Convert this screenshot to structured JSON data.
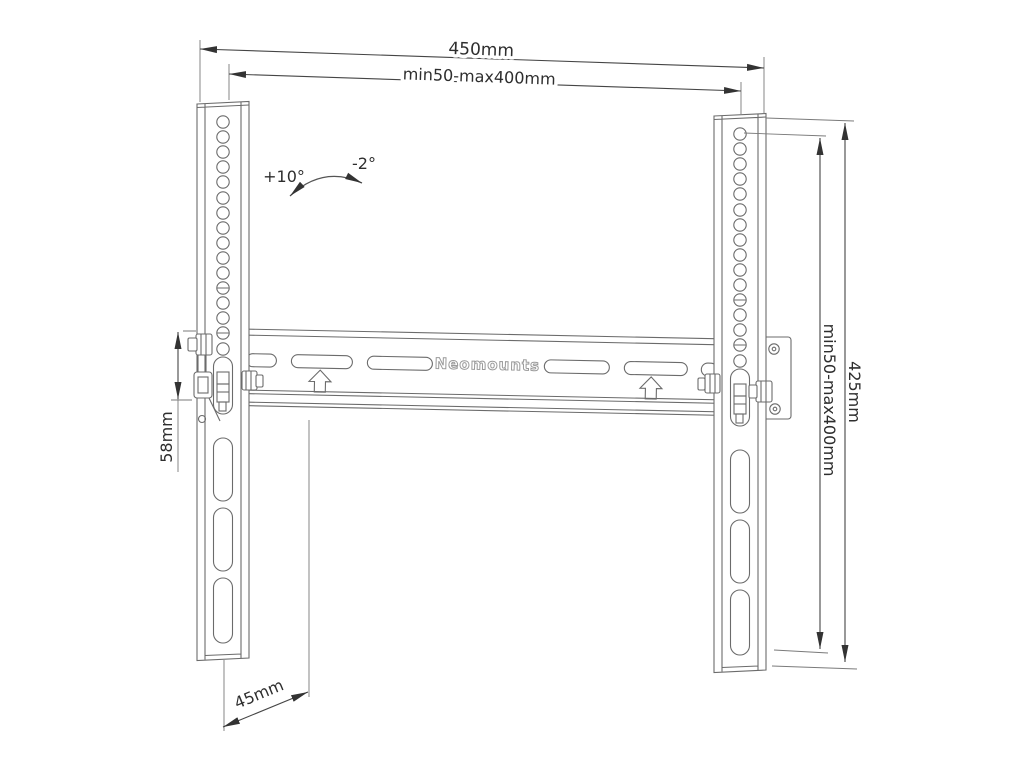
{
  "diagram": {
    "brand": "Neomounts",
    "dim_top_width": "450mm",
    "dim_top_hole_pattern": "min50-max400mm",
    "dim_right_height": "425mm",
    "dim_right_hole_pattern": "min50-max400mm",
    "dim_plate_height": "58mm",
    "dim_wall_depth": "45mm",
    "angle_tilt_up": "+10°",
    "angle_tilt_down": "-2°"
  }
}
